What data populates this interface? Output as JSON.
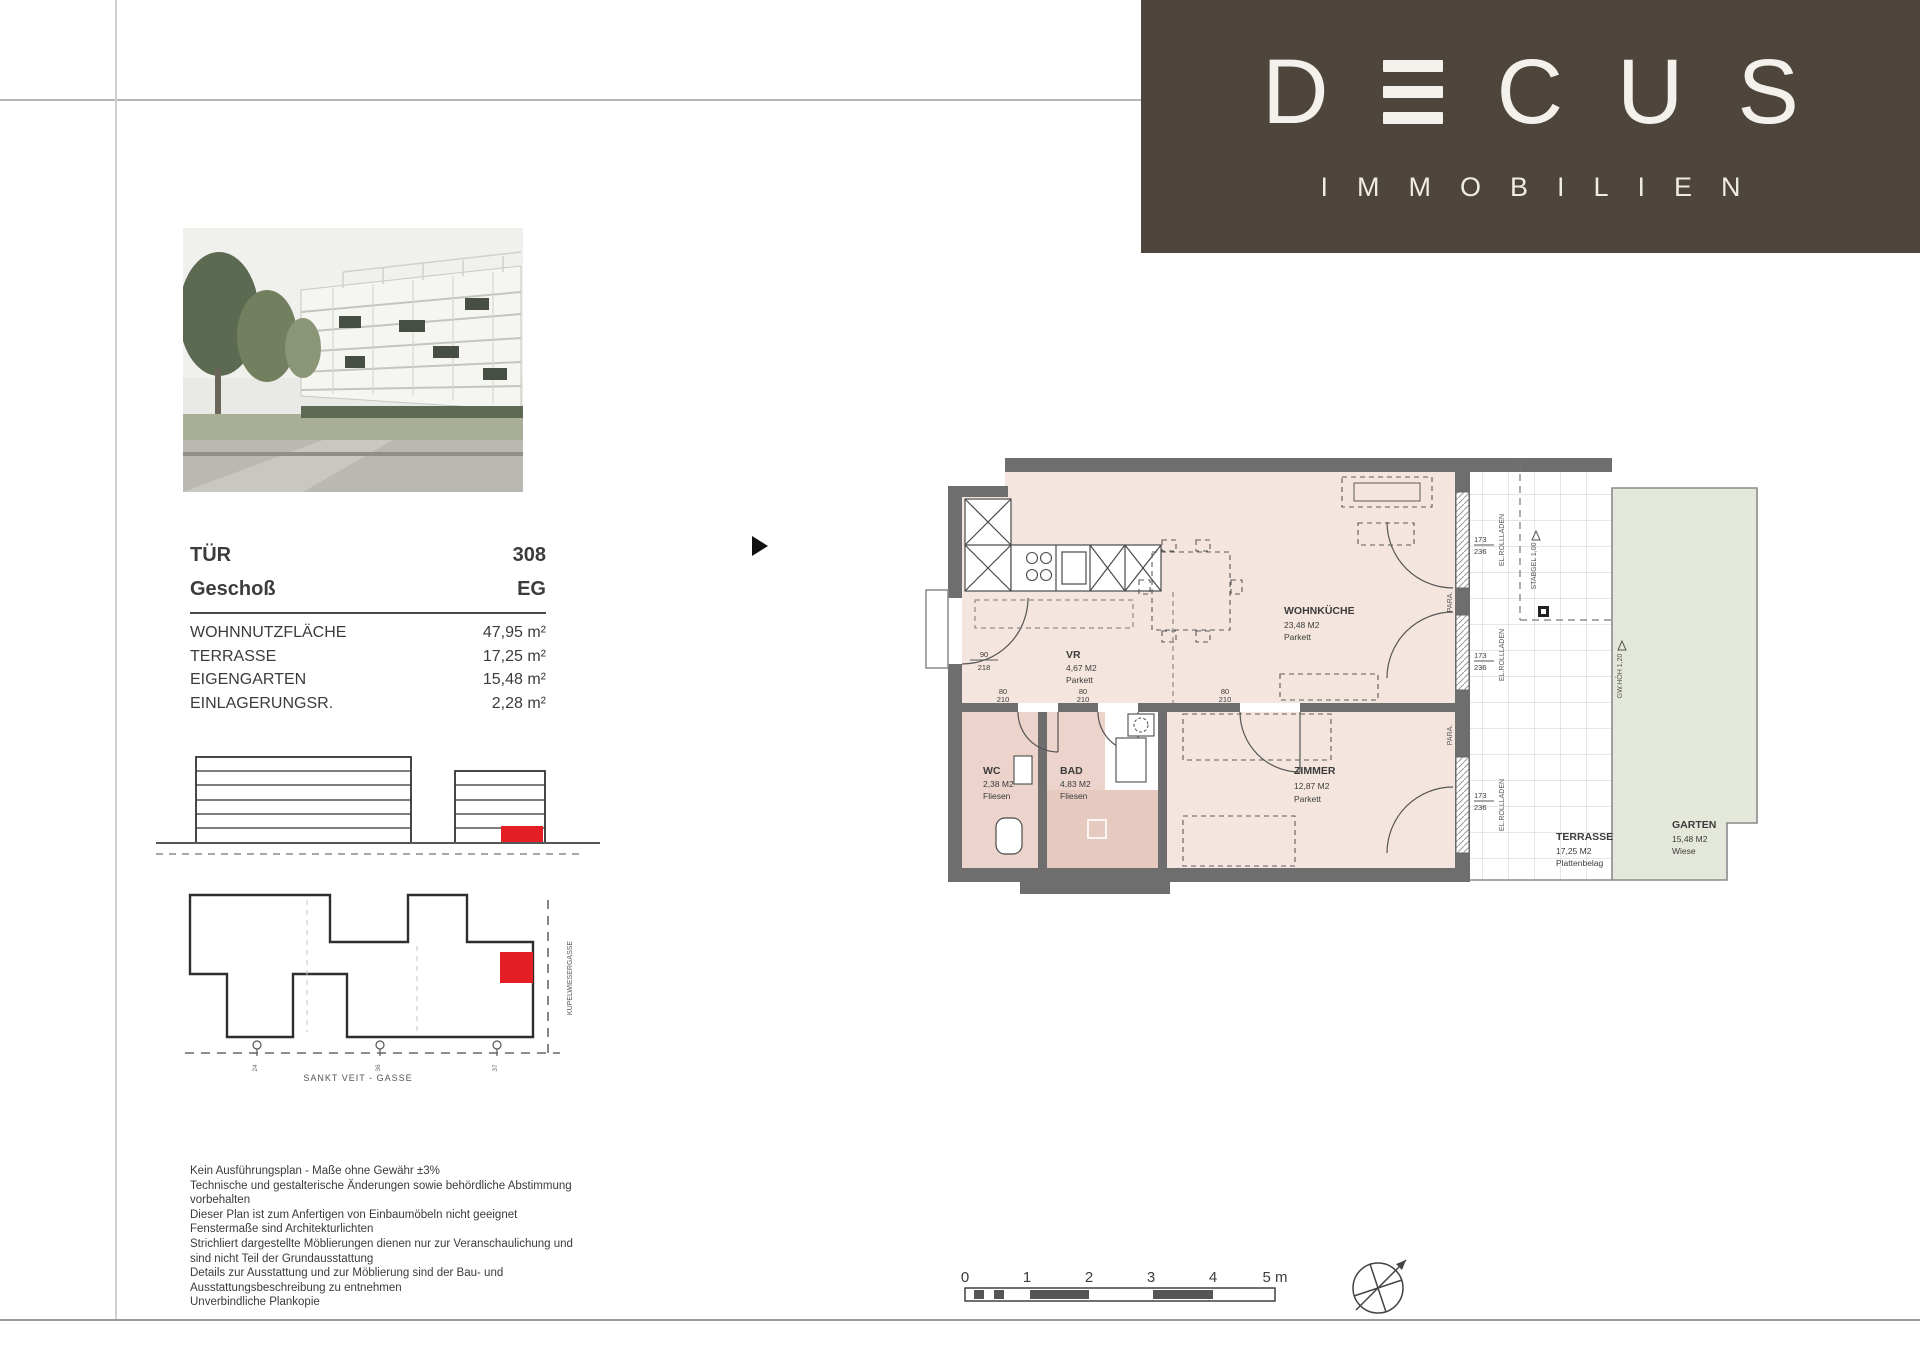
{
  "brand": {
    "word_left": "D",
    "word_right": "CUS",
    "tagline": "IMMOBILIEN"
  },
  "unit": {
    "door_label": "TÜR",
    "door_value": "308",
    "floor_label": "Geschoß",
    "floor_value": "EG",
    "areas": [
      {
        "label": "WOHNNUTZFLÄCHE",
        "value": "47,95 m²"
      },
      {
        "label": "TERRASSE",
        "value": "17,25 m²"
      },
      {
        "label": "EIGENGARTEN",
        "value": "15,48 m²"
      },
      {
        "label": "EINLAGERUNGSR.",
        "value": "2,28 m²"
      }
    ]
  },
  "floor_plan": {
    "rooms": [
      {
        "name": "WOHNKÜCHE",
        "area": "23,48 M2",
        "floor": "Parkett"
      },
      {
        "name": "VR",
        "area": "4,67 M2",
        "floor": "Parkett"
      },
      {
        "name": "WC",
        "area": "2,38 M2",
        "floor": "Fliesen"
      },
      {
        "name": "BAD",
        "area": "4,83 M2",
        "floor": "Fliesen"
      },
      {
        "name": "ZIMMER",
        "area": "12,87 M2",
        "floor": "Parkett"
      },
      {
        "name": "TERRASSE",
        "area": "17,25 M2",
        "floor": "Plattenbelag"
      },
      {
        "name": "GARTEN",
        "area": "15,48 M2",
        "floor": "Wiese"
      }
    ],
    "dims": {
      "entry_door": [
        "90",
        "218"
      ],
      "interior_door": [
        "80",
        "210"
      ],
      "window": [
        "173",
        "236"
      ]
    },
    "annotations": {
      "shutter": "EL.ROLLLADEN",
      "railing": "STABGEL 1,00",
      "garden_wall": "GW.HÖH 1,20",
      "parapet": "PARA."
    }
  },
  "site_plan": {
    "street_bottom": "SANKT VEIT - GASSE",
    "street_side": "KUPELWIESERGASSE",
    "marker_values": [
      "24",
      "36",
      "37"
    ]
  },
  "disclaimer_lines": [
    "Kein Ausführungsplan - Maße ohne Gewähr ±3%",
    "Technische und gestalterische Änderungen sowie behördliche Abstimmung",
    "vorbehalten",
    "Dieser Plan ist zum Anfertigen von Einbaumöbeln nicht geeignet",
    "Fenstermaße sind Architekturlichten",
    "Strichliert dargestellte Möblierungen dienen nur zur Veranschaulichung und",
    "sind nicht Teil der Grundausstattung",
    "Details zur Ausstattung und zur Möblierung sind der Bau- und",
    "Ausstattungsbeschreibung zu entnehmen",
    "Unverbindliche Plankopie"
  ],
  "scale_bar": {
    "ticks": [
      "0",
      "1",
      "2",
      "3",
      "4",
      "5 m"
    ]
  }
}
